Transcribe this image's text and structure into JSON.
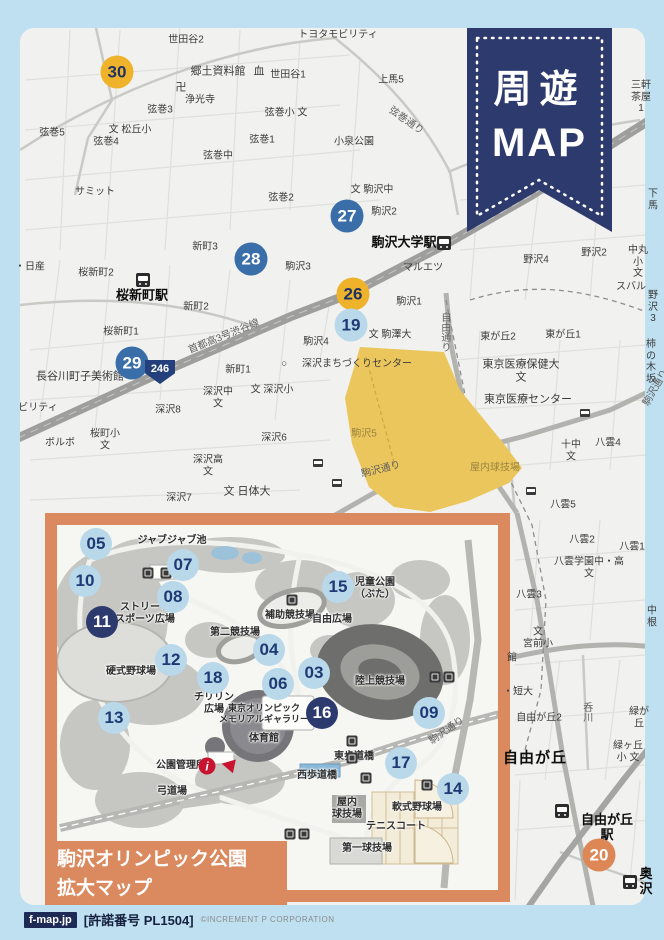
{
  "colors": {
    "frame_blue": "#bfe0f1",
    "accent_navy": "#2d3a6d",
    "inset_orange": "#db8a5f",
    "park_yellow": "#ebc65c",
    "marker_blue": "#3a6ea8",
    "marker_yellow": "#eeb32a",
    "marker_lightblue": "#b9d8ea",
    "marker_orange": "#dd8757",
    "info_red": "#c81430"
  },
  "ribbon": {
    "line1": "周遊",
    "line2": "MAP"
  },
  "footer": {
    "site": "f-map.jp",
    "license": "[許諾番号 PL1504]",
    "copyright": "©INCREMENT P CORPORATION"
  },
  "main_map": {
    "route_shield": "246",
    "markers": [
      {
        "num": "30",
        "x": 117,
        "y": 72,
        "style": "yellow"
      },
      {
        "num": "27",
        "x": 347,
        "y": 216,
        "style": "blue"
      },
      {
        "num": "28",
        "x": 251,
        "y": 259,
        "style": "blue"
      },
      {
        "num": "26",
        "x": 353,
        "y": 294,
        "style": "yellow"
      },
      {
        "num": "19",
        "x": 351,
        "y": 325,
        "style": "lightblue"
      },
      {
        "num": "29",
        "x": 132,
        "y": 363,
        "style": "blue"
      },
      {
        "num": "20",
        "x": 599,
        "y": 855,
        "style": "orange"
      }
    ],
    "stations": [
      {
        "x": 143,
        "y": 280
      },
      {
        "x": 444,
        "y": 243
      },
      {
        "x": 562,
        "y": 811
      },
      {
        "x": 630,
        "y": 882
      }
    ],
    "bus_icons": [
      {
        "x": 585,
        "y": 413
      },
      {
        "x": 318,
        "y": 463
      },
      {
        "x": 337,
        "y": 483
      },
      {
        "x": 531,
        "y": 491
      }
    ],
    "labels": [
      {
        "t": "世田谷2",
        "x": 186,
        "y": 40
      },
      {
        "t": "郷土資料館",
        "x": 218,
        "y": 72,
        "cls": "md"
      },
      {
        "t": "血",
        "x": 259,
        "y": 72,
        "cls": "md"
      },
      {
        "t": "世田谷1",
        "x": 288,
        "y": 75
      },
      {
        "t": "卍",
        "x": 181,
        "y": 88,
        "cls": "md"
      },
      {
        "t": "浄光寺",
        "x": 200,
        "y": 100
      },
      {
        "t": "弦巻3",
        "x": 160,
        "y": 110
      },
      {
        "t": "文 松丘小",
        "x": 130,
        "y": 130
      },
      {
        "t": "弦巻5",
        "x": 52,
        "y": 133
      },
      {
        "t": "弦巻4",
        "x": 106,
        "y": 142
      },
      {
        "t": "弦巻中",
        "x": 218,
        "y": 156
      },
      {
        "t": "弦巻小 文",
        "x": 286,
        "y": 113
      },
      {
        "t": "弦巻1",
        "x": 262,
        "y": 140
      },
      {
        "t": "小泉公園",
        "x": 354,
        "y": 142
      },
      {
        "t": "トヨタモビリティ",
        "x": 338,
        "y": 35
      },
      {
        "t": "上馬5",
        "x": 391,
        "y": 80
      },
      {
        "t": "三軒茶屋1",
        "x": 641,
        "y": 97
      },
      {
        "t": "下馬",
        "x": 653,
        "y": 200
      },
      {
        "t": "サミット",
        "x": 95,
        "y": 192
      },
      {
        "t": "文 駒沢中",
        "x": 372,
        "y": 190
      },
      {
        "t": "駒沢2",
        "x": 384,
        "y": 212
      },
      {
        "t": "弦巻2",
        "x": 281,
        "y": 198
      },
      {
        "t": "新町3",
        "x": 205,
        "y": 247
      },
      {
        "t": "駒沢3",
        "x": 298,
        "y": 267
      },
      {
        "t": "駒沢大学駅",
        "x": 404,
        "y": 243,
        "cls": "station"
      },
      {
        "t": "マルエツ",
        "x": 423,
        "y": 268
      },
      {
        "t": "駒沢1",
        "x": 409,
        "y": 302
      },
      {
        "t": "・日産",
        "x": 30,
        "y": 267
      },
      {
        "t": "桜新町2",
        "x": 96,
        "y": 273
      },
      {
        "t": "桜新町駅",
        "x": 142,
        "y": 296,
        "cls": "station"
      },
      {
        "t": "新町2",
        "x": 196,
        "y": 307
      },
      {
        "t": "桜新町1",
        "x": 121,
        "y": 332
      },
      {
        "t": "新町1",
        "x": 238,
        "y": 370
      },
      {
        "t": "駒沢4",
        "x": 316,
        "y": 342
      },
      {
        "t": "○",
        "x": 284,
        "y": 364
      },
      {
        "t": "深沢まちづくりセンター",
        "x": 357,
        "y": 364
      },
      {
        "t": "文 駒澤大",
        "x": 390,
        "y": 335
      },
      {
        "t": "東が丘2",
        "x": 498,
        "y": 337
      },
      {
        "t": "東が丘1",
        "x": 563,
        "y": 335
      },
      {
        "t": "野沢4",
        "x": 536,
        "y": 260
      },
      {
        "t": "野沢2",
        "x": 594,
        "y": 253
      },
      {
        "t": "中丸小\n文",
        "x": 638,
        "y": 262
      },
      {
        "t": "スバル",
        "x": 631,
        "y": 287
      },
      {
        "t": "野沢3",
        "x": 653,
        "y": 307
      },
      {
        "t": "東京医療保健大\n文",
        "x": 521,
        "y": 371,
        "cls": "md"
      },
      {
        "t": "東京医療センター",
        "x": 528,
        "y": 400,
        "cls": "md"
      },
      {
        "t": "柿の木坂",
        "x": 651,
        "y": 362
      },
      {
        "t": "長谷川町子美術館",
        "x": 80,
        "y": 377,
        "cls": "md"
      },
      {
        "t": "ビリティ",
        "x": 38,
        "y": 408
      },
      {
        "t": "ボルボ",
        "x": 60,
        "y": 443
      },
      {
        "t": "桜町小\n文",
        "x": 105,
        "y": 440
      },
      {
        "t": "深沢8",
        "x": 168,
        "y": 410
      },
      {
        "t": "深沢中\n文",
        "x": 218,
        "y": 398
      },
      {
        "t": "文 深沢小",
        "x": 272,
        "y": 390
      },
      {
        "t": "深沢6",
        "x": 274,
        "y": 438
      },
      {
        "t": "深沢高\n文",
        "x": 208,
        "y": 466
      },
      {
        "t": "深沢7",
        "x": 179,
        "y": 498
      },
      {
        "t": "文 日体大",
        "x": 247,
        "y": 492,
        "cls": "md"
      },
      {
        "t": "駒沢5",
        "x": 364,
        "y": 434,
        "cls": "faded"
      },
      {
        "t": "屋内球技場",
        "x": 495,
        "y": 468,
        "cls": "faded"
      },
      {
        "t": "十中\n文",
        "x": 571,
        "y": 451
      },
      {
        "t": "八雲4",
        "x": 608,
        "y": 443
      },
      {
        "t": "八雲5",
        "x": 563,
        "y": 505
      },
      {
        "t": "八雲2",
        "x": 582,
        "y": 540
      },
      {
        "t": "八雲1",
        "x": 632,
        "y": 547
      },
      {
        "t": "八雲学園中・高\n文",
        "x": 589,
        "y": 568
      },
      {
        "t": "八雲3",
        "x": 529,
        "y": 595
      },
      {
        "t": "中根",
        "x": 652,
        "y": 617
      },
      {
        "t": "文\n宮前小",
        "x": 538,
        "y": 638
      },
      {
        "t": "館",
        "x": 512,
        "y": 658
      },
      {
        "t": "・短大",
        "x": 518,
        "y": 692
      },
      {
        "t": "自由が丘2",
        "x": 539,
        "y": 718
      },
      {
        "t": "緑が丘",
        "x": 639,
        "y": 718
      },
      {
        "t": "緑ヶ丘小 文",
        "x": 628,
        "y": 752
      },
      {
        "t": "自由が丘",
        "x": 535,
        "y": 758,
        "cls": "big"
      },
      {
        "t": "自由が丘駅",
        "x": 607,
        "y": 828,
        "cls": "station"
      },
      {
        "t": "奥沢",
        "x": 646,
        "y": 882,
        "cls": "station"
      }
    ],
    "road_labels": [
      {
        "t": "首都高3号渋谷線",
        "x": 224,
        "y": 337,
        "rot": -22
      },
      {
        "t": "弦巻通り",
        "x": 406,
        "y": 121,
        "rot": 35
      },
      {
        "t": "駒沢通り",
        "x": 381,
        "y": 470,
        "rot": -14
      },
      {
        "t": "自由通り",
        "x": 444,
        "y": 332,
        "vert": true
      },
      {
        "t": "呑川",
        "x": 586,
        "y": 712,
        "vert": true
      },
      {
        "t": "駒沢通り",
        "x": 656,
        "y": 388,
        "rot": -60
      }
    ]
  },
  "inset": {
    "title1": "駒沢オリンピック公園",
    "title2": "拡大マップ",
    "markers": [
      {
        "num": "05",
        "x": 96,
        "y": 544,
        "style": "lightblue"
      },
      {
        "num": "07",
        "x": 183,
        "y": 565,
        "style": "lightblue"
      },
      {
        "num": "10",
        "x": 85,
        "y": 581,
        "style": "lightblue"
      },
      {
        "num": "08",
        "x": 173,
        "y": 597,
        "style": "lightblue"
      },
      {
        "num": "11",
        "x": 102,
        "y": 622,
        "style": "navy"
      },
      {
        "num": "12",
        "x": 171,
        "y": 660,
        "style": "lightblue"
      },
      {
        "num": "18",
        "x": 213,
        "y": 678,
        "style": "lightblue"
      },
      {
        "num": "13",
        "x": 114,
        "y": 718,
        "style": "lightblue"
      },
      {
        "num": "15",
        "x": 338,
        "y": 587,
        "style": "lightblue"
      },
      {
        "num": "04",
        "x": 269,
        "y": 650,
        "style": "lightblue"
      },
      {
        "num": "03",
        "x": 314,
        "y": 673,
        "style": "lightblue"
      },
      {
        "num": "06",
        "x": 278,
        "y": 684,
        "style": "lightblue"
      },
      {
        "num": "16",
        "x": 322,
        "y": 713,
        "style": "navy"
      },
      {
        "num": "09",
        "x": 429,
        "y": 713,
        "style": "lightblue"
      },
      {
        "num": "17",
        "x": 401,
        "y": 763,
        "style": "lightblue"
      },
      {
        "num": "14",
        "x": 453,
        "y": 789,
        "style": "lightblue"
      }
    ],
    "labels": [
      {
        "t": "ジャブジャブ池",
        "x": 172,
        "y": 541
      },
      {
        "t": "ストリート\nスポーツ広場",
        "x": 145,
        "y": 614
      },
      {
        "t": "第二競技場",
        "x": 235,
        "y": 633
      },
      {
        "t": "補助競技場",
        "x": 290,
        "y": 616
      },
      {
        "t": "自由広場",
        "x": 332,
        "y": 620
      },
      {
        "t": "児童公園\n（ぶた）",
        "x": 375,
        "y": 589
      },
      {
        "t": "硬式野球場",
        "x": 131,
        "y": 672
      },
      {
        "t": "チリリン\n広場",
        "x": 214,
        "y": 704
      },
      {
        "t": "東京オリンピック\nメモリアルギャラリー",
        "x": 264,
        "y": 714,
        "cls": "tiny"
      },
      {
        "t": "体育館",
        "x": 264,
        "y": 739
      },
      {
        "t": "陸上競技場",
        "x": 380,
        "y": 682
      },
      {
        "t": "公園管理所",
        "x": 181,
        "y": 766
      },
      {
        "t": "弓道場",
        "x": 172,
        "y": 792
      },
      {
        "t": "西歩道橋",
        "x": 317,
        "y": 776
      },
      {
        "t": "東歩道橋",
        "x": 354,
        "y": 757
      },
      {
        "t": "屋内\n球技場",
        "x": 347,
        "y": 809
      },
      {
        "t": "軟式野球場",
        "x": 417,
        "y": 808
      },
      {
        "t": "テニスコート",
        "x": 396,
        "y": 827
      },
      {
        "t": "第一球技場",
        "x": 367,
        "y": 849
      }
    ],
    "road_labels": [
      {
        "t": "駒沢通り",
        "x": 447,
        "y": 731,
        "rot": -35
      }
    ],
    "facility_icons": [
      {
        "x": 148,
        "y": 573
      },
      {
        "x": 166,
        "y": 573
      },
      {
        "x": 292,
        "y": 600
      },
      {
        "x": 435,
        "y": 677
      },
      {
        "x": 449,
        "y": 677
      },
      {
        "x": 352,
        "y": 741
      },
      {
        "x": 352,
        "y": 758
      },
      {
        "x": 366,
        "y": 778
      },
      {
        "x": 427,
        "y": 785
      },
      {
        "x": 290,
        "y": 834
      },
      {
        "x": 304,
        "y": 834
      }
    ],
    "info": {
      "glyph": "i",
      "x": 207,
      "y": 766
    },
    "arrow": {
      "x": 228,
      "y": 765
    }
  }
}
